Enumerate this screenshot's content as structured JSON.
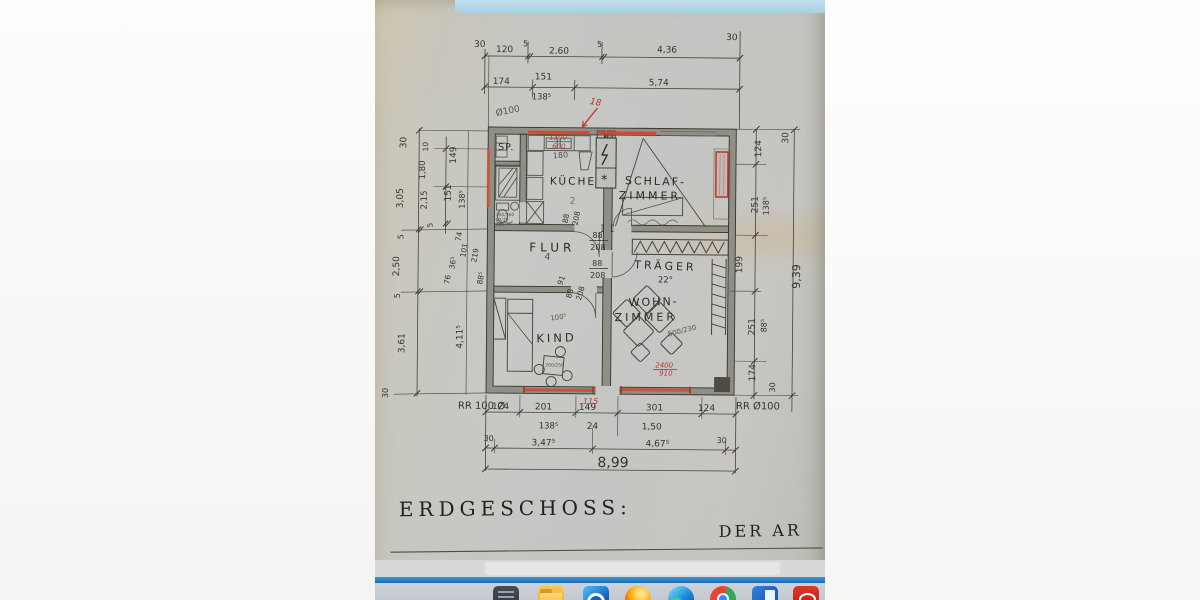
{
  "plan": {
    "title": "ERDGESCHOSS:",
    "signature": "DER AR",
    "rooms": {
      "sp": "SP.",
      "kueche": "KÜCHE",
      "schlaf1": "SCHLAF-",
      "schlaf2": "ZIMMER",
      "flur": "FLUR",
      "traeger": "TRÄGER",
      "wohn1": "WOHN-",
      "wohn2": "ZIMMER",
      "kind": "KIND"
    },
    "top1": [
      "30",
      "120",
      "5",
      "2,60",
      "5",
      "4,36",
      "30"
    ],
    "top2": [
      "174",
      "151",
      "138⁵",
      "5,74"
    ],
    "note_dia": "Ø100",
    "left_outer": [
      "30",
      "3,05",
      "5",
      "2,50",
      "5",
      "3,61",
      "30"
    ],
    "left_inner": [
      "10",
      "1,80",
      "2,15",
      "5"
    ],
    "left_wall": [
      "149",
      "151",
      "138⁵",
      "4,11⁵"
    ],
    "left_cluster": [
      "74",
      "101",
      "36⁵",
      "76",
      "219",
      "88⁵"
    ],
    "right_inner": [
      "124",
      "251",
      "138⁵",
      "199",
      "251",
      "88⁵",
      "174",
      "30"
    ],
    "right_outer": [
      "30",
      "9,39"
    ],
    "bottom1": [
      "124",
      "201",
      "149",
      "301",
      "124"
    ],
    "bottom2": [
      "138⁵",
      "24",
      "1,50"
    ],
    "bottom3": [
      "30",
      "3,47⁵",
      "4,67⁵",
      "30"
    ],
    "total": "8,99",
    "rr_left": "RR 100 Ø",
    "rr_right": "RR Ø100",
    "door": {
      "w": "88",
      "h": "208",
      "n91": "91"
    },
    "red": {
      "n18": "18",
      "n115": "115",
      "sink1": "1300",
      "sink2": "600",
      "sofa1": "2400",
      "sofa2": "910"
    },
    "notes": {
      "n180": "180",
      "n2": "2",
      "n4": "4",
      "n100": "100⁵",
      "beam": "22°",
      "sofa": "500/230",
      "f1": "300/360",
      "f2": "60/78",
      "f3": "296",
      "table": "200/256",
      "star": "*"
    }
  },
  "taskbar": {
    "icons": [
      "app-grid",
      "file-explorer",
      "outlook",
      "firefox",
      "edge",
      "chrome",
      "word",
      "acrobat"
    ]
  }
}
